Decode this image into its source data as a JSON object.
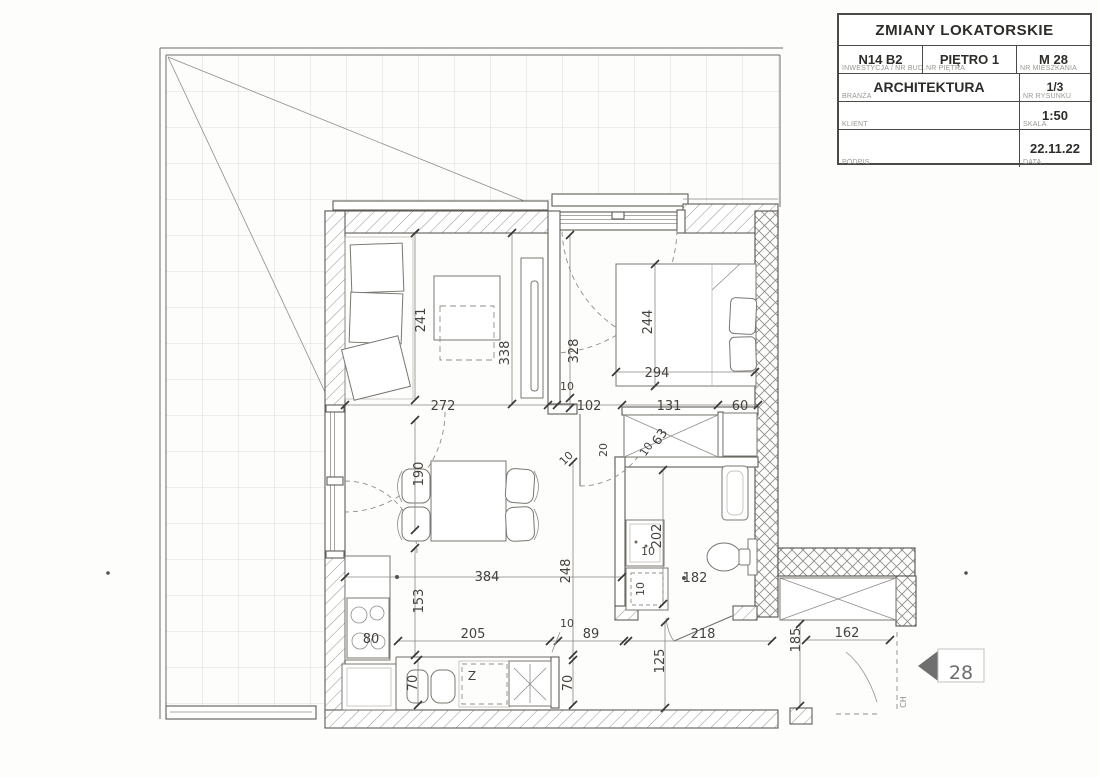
{
  "title_block": {
    "title": "ZMIANY LOKATORSKIE",
    "cells": {
      "investment": {
        "value": "N14 B2",
        "label": "INWESTYCJA / NR BUD."
      },
      "floor": {
        "value": "PIĘTRO 1",
        "label": "NR PIĘTRA"
      },
      "apartment": {
        "value": "M 28",
        "label": "NR MIESZKANIA"
      },
      "branch": {
        "value": "ARCHITEKTURA",
        "label": "BRANŻA"
      },
      "drawing_no": {
        "value": "1/3",
        "label": "NR RYSUNKU"
      },
      "client": {
        "value": "",
        "label": "KLIENT"
      },
      "scale": {
        "value": "1:50",
        "label": "SKALA"
      },
      "signature": {
        "value": "",
        "label": "PODPIS"
      },
      "date": {
        "value": "22.11.22",
        "label": "DATA"
      }
    }
  },
  "plan": {
    "marker": {
      "number": "28"
    },
    "labels": {
      "dishwasher": "Z",
      "hob": "80",
      "door_mark": "CH"
    },
    "dims": {
      "living_depth": "241",
      "living_width": "272",
      "living_partition": "338",
      "bedroom_partition": "328",
      "bed_length": "244",
      "bed_width": "294",
      "bedroom_door": "102",
      "wardrobe_width": "131",
      "shaft_width": "60",
      "wardrobe_depth": "63",
      "hall_notch": "20",
      "dining_zone": "190",
      "hall_width": "384",
      "hall_length": "248",
      "kitchen_zone": "153",
      "kitchen_run": "205",
      "kitchen_end": "89",
      "counter_depth_left": "70",
      "counter_depth_bottom": "70",
      "corridor_width": "125",
      "corridor_length": "218",
      "entry_length": "185",
      "entry_width": "162",
      "bath_length": "202",
      "bath_width": "182",
      "t10_partition": "10",
      "t10_wardrobe": "10",
      "t10_tv": "10",
      "t10_kitchen": "10",
      "t10_basin": "10",
      "t10_wm": "10"
    }
  },
  "colors": {
    "wall_line": "#5f5c58",
    "dim_text": "#45423e",
    "marker_arrow": "#6f6f6f",
    "paper": "#fdfdfb"
  }
}
